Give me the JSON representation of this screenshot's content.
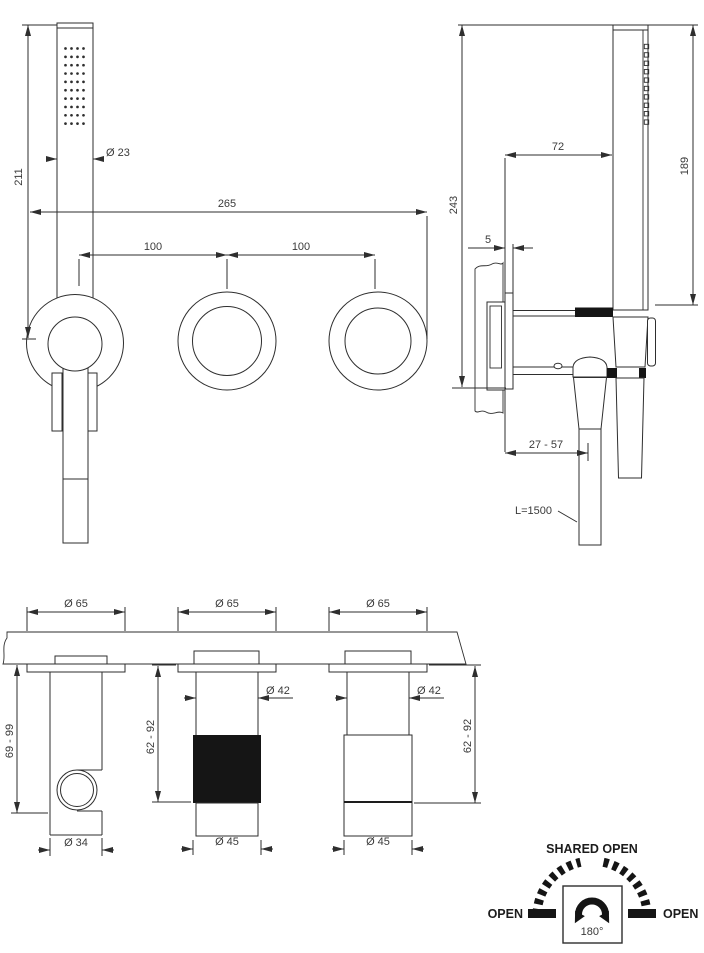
{
  "front_view": {
    "height_dim": "211",
    "overall_width_dim": "265",
    "spacing_dim_left": "100",
    "spacing_dim_right": "100",
    "handshower_diameter_dim": "Ø 23"
  },
  "side_view": {
    "depth_dim": "243",
    "offset_dim": "72",
    "handshower_height_dim": "189",
    "plate_projection_dim": "5",
    "wall_depth_range_dim": "27 - 57",
    "hose_length_label": "L=1500"
  },
  "bottom_view": {
    "plate_diameter_dims": [
      "Ø 65",
      "Ø 65",
      "Ø 65"
    ],
    "stem_diameter_dims": [
      "Ø 42",
      "Ø 42"
    ],
    "knob_diameter_dims": [
      "Ø 45",
      "Ø 45"
    ],
    "holder_diameter_dim": "Ø 34",
    "holder_depth_range_dim": "69 - 99",
    "knob_depth_range_dims": [
      "62 - 92",
      "62 - 92"
    ]
  },
  "rotation_diagram": {
    "title": "SHARED OPEN",
    "left_label": "OPEN",
    "right_label": "OPEN",
    "angle_label": "180°"
  },
  "colors": {
    "line": "#2e2e2e",
    "text": "#3a3a3a",
    "solid": "#151515",
    "background": "#ffffff"
  }
}
